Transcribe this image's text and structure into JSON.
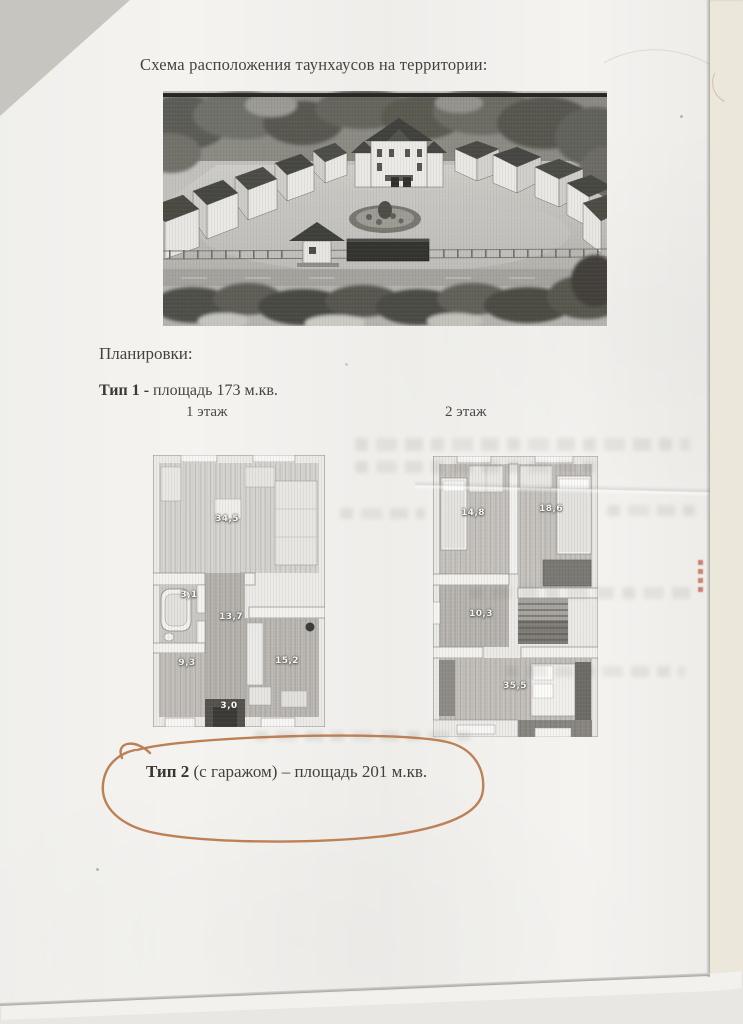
{
  "document": {
    "title": "Схема расположения таунхаусов на территории:",
    "plans_heading": "Планировки:",
    "type1_bold": "Тип 1 -",
    "type1_rest": " площадь 173 м.кв.",
    "floor1_label": "1 этаж",
    "floor2_label": "2 этаж",
    "type2_bold": "Тип 2",
    "type2_rest": " (с гаражом) – площадь 201 м.кв."
  },
  "floorplans": {
    "floor1": {
      "rooms": [
        {
          "name": "living-room",
          "area": "34,5"
        },
        {
          "name": "bathroom",
          "area": "3,1"
        },
        {
          "name": "hallway",
          "area": "13,7"
        },
        {
          "name": "bedroom",
          "area": "9,3"
        },
        {
          "name": "kitchen",
          "area": "15,2"
        },
        {
          "name": "entry",
          "area": "3,0"
        }
      ]
    },
    "floor2": {
      "rooms": [
        {
          "name": "bedroom-left",
          "area": "14,8"
        },
        {
          "name": "bedroom-right",
          "area": "18,6"
        },
        {
          "name": "hallway",
          "area": "10,3"
        },
        {
          "name": "master-bedroom",
          "area": "35,5"
        }
      ]
    }
  },
  "annotation": {
    "pen_color": "#b9774a"
  }
}
